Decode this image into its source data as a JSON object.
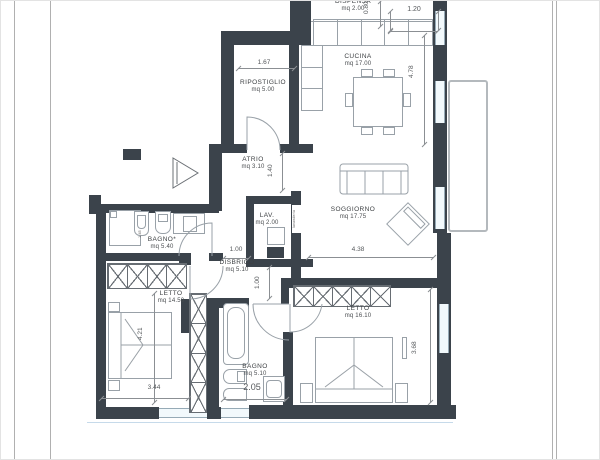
{
  "rooms": {
    "dispensa": {
      "label": "DISPENSA",
      "area": "mq  2.00"
    },
    "cucina": {
      "label": "CUCINA",
      "area": "mq  17.00"
    },
    "ripostiglio": {
      "label": "RIPOSTIGLIO",
      "area": "mq  5.00"
    },
    "atrio": {
      "label": "ATRIO",
      "area": "mq  3.10"
    },
    "lav": {
      "label": "LAV.",
      "area": "mq  2.00"
    },
    "soggiorno": {
      "label": "SOGGIORNO",
      "area": "mq  17.75"
    },
    "bagno1": {
      "label": "BAGNO*",
      "area": "mq  5.40"
    },
    "disbrigo": {
      "label": "DISBRIGO",
      "area": "mq  5.10"
    },
    "letto1": {
      "label": "LETTO",
      "area": "mq  14.50"
    },
    "bagno2": {
      "label": "BAGNO",
      "area": "mq  5.10"
    },
    "letto2": {
      "label": "LETTO",
      "area": "mq  16.10"
    }
  },
  "dims": {
    "d167": "1.67",
    "d120": "1.20",
    "d080": "0.80",
    "d478": "4.78",
    "d140": "1.40",
    "d100a": "1.00",
    "d100b": "1.00",
    "d438": "4.38",
    "d421": "4.21",
    "d344": "3.44",
    "d205": "2.05",
    "d368": "3.68",
    "d145": "1.45"
  },
  "annotations": {
    "lav_note": "lavanderia"
  },
  "colors": {
    "wall": "#3b434b",
    "window": "#f2f9fc",
    "dimension": "#55585b"
  }
}
